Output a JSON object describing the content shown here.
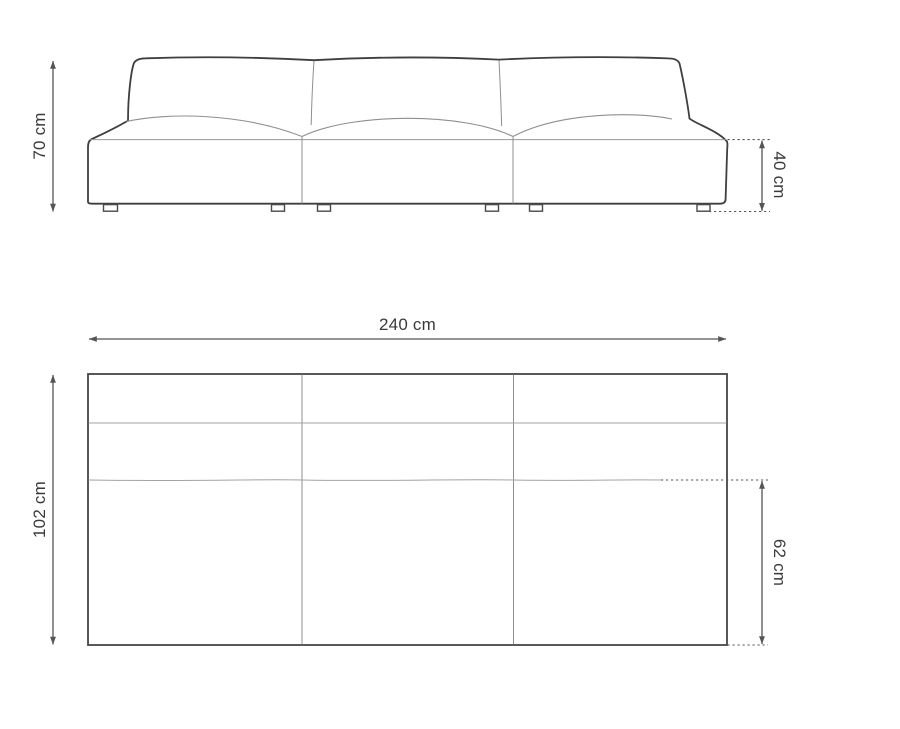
{
  "diagram": {
    "subject": "three-module armless modular sofa dimension drawing",
    "views": {
      "front": {
        "name": "front elevation",
        "modules": 3,
        "dimensions": {
          "total_height": {
            "label": "70 cm",
            "value_cm": 70,
            "side": "left",
            "orientation": "vertical"
          },
          "seat_height": {
            "label": "40 cm",
            "value_cm": 40,
            "side": "right",
            "orientation": "vertical"
          }
        }
      },
      "top": {
        "name": "top plan view",
        "modules": 3,
        "dimensions": {
          "total_width": {
            "label": "240 cm",
            "value_cm": 240,
            "side": "top",
            "orientation": "horizontal"
          },
          "total_depth": {
            "label": "102 cm",
            "value_cm": 102,
            "side": "left",
            "orientation": "vertical"
          },
          "seat_depth": {
            "label": "62 cm",
            "value_cm": 62,
            "side": "right",
            "orientation": "vertical"
          }
        }
      }
    },
    "colors": {
      "background": "#ffffff",
      "outline_dark": "#3f3f3f",
      "line_light": "#9a9a9a",
      "dimension_line": "#555555",
      "text": "#3a3a3a"
    }
  }
}
